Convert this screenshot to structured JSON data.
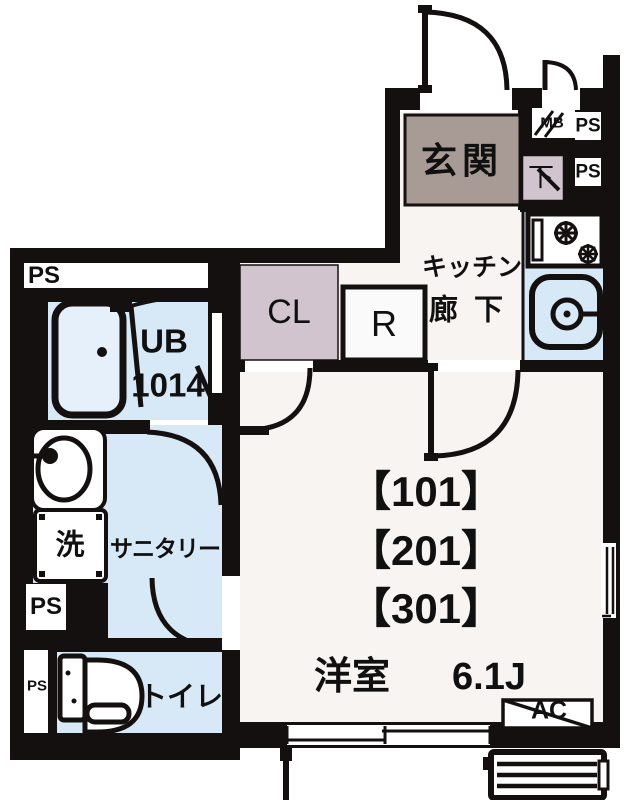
{
  "rooms": {
    "genkan": "玄関",
    "kitchen_line1": "キッチン",
    "kitchen_line2": "廊下",
    "closet": "CL",
    "refrigerator": "R",
    "unit_bath_line1": "UB",
    "unit_bath_line2": "1014",
    "sanitary": "サニタリー",
    "washer": "洗",
    "toilet": "トイレ",
    "western_room": "洋室",
    "western_room_size": "6.1J",
    "shoe_box": "下"
  },
  "units": [
    "【101】",
    "【201】",
    "【301】"
  ],
  "labels": {
    "ps": "PS",
    "mb": "MB",
    "ac": "AC"
  },
  "colors": {
    "wall": "#151010",
    "floor": "#f7f4f1",
    "wet_blue": "#d7e8f6",
    "genkan_brown": "#a89a94",
    "mauve": "#d1c4ce"
  }
}
